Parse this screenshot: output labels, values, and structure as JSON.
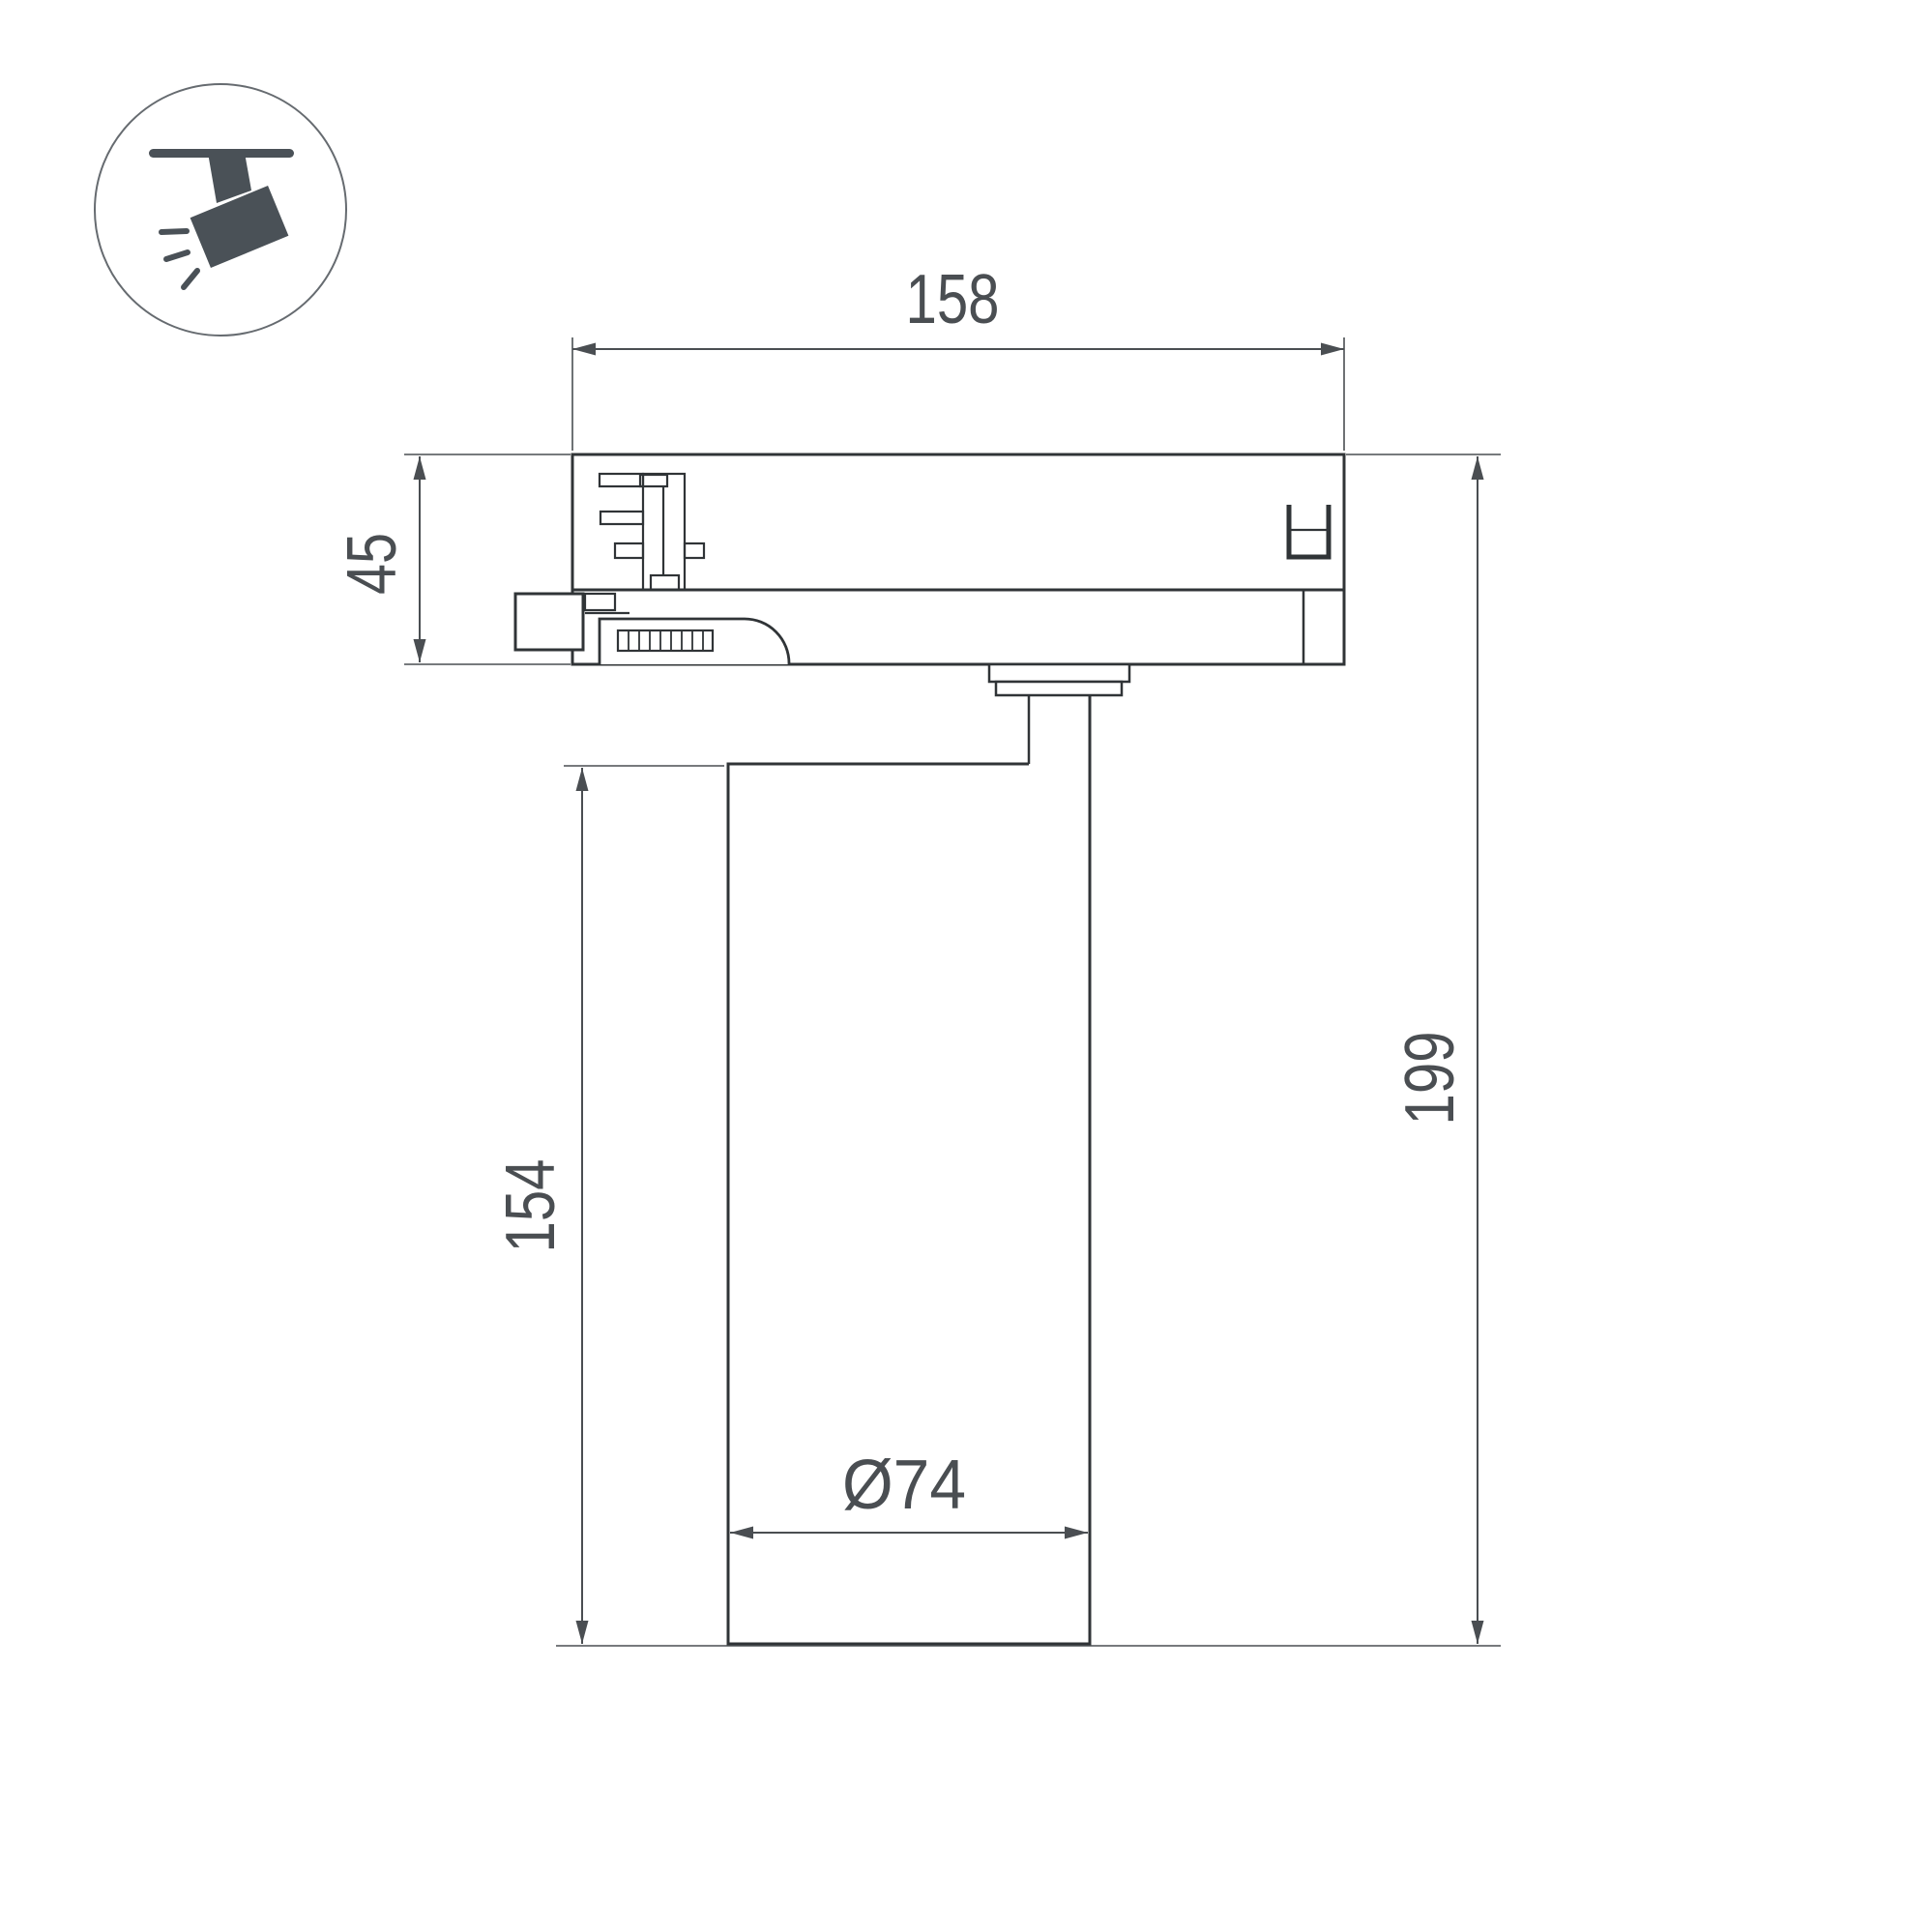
{
  "drawing": {
    "title": "track-spotlight-dimension-drawing",
    "background": "#ffffff",
    "colors": {
      "outline": "#303437",
      "dimension": "#4a4e52",
      "icon_fill": "#4a5157",
      "icon_circle_stroke": "#666b70"
    },
    "icon": {
      "name": "track-spotlight"
    },
    "dimensions": {
      "track_width": {
        "label": "158"
      },
      "adapter_height": {
        "label": "45"
      },
      "body_height": {
        "label": "154"
      },
      "total_height": {
        "label": "199"
      },
      "body_diameter": {
        "label": "Ø74"
      }
    }
  }
}
